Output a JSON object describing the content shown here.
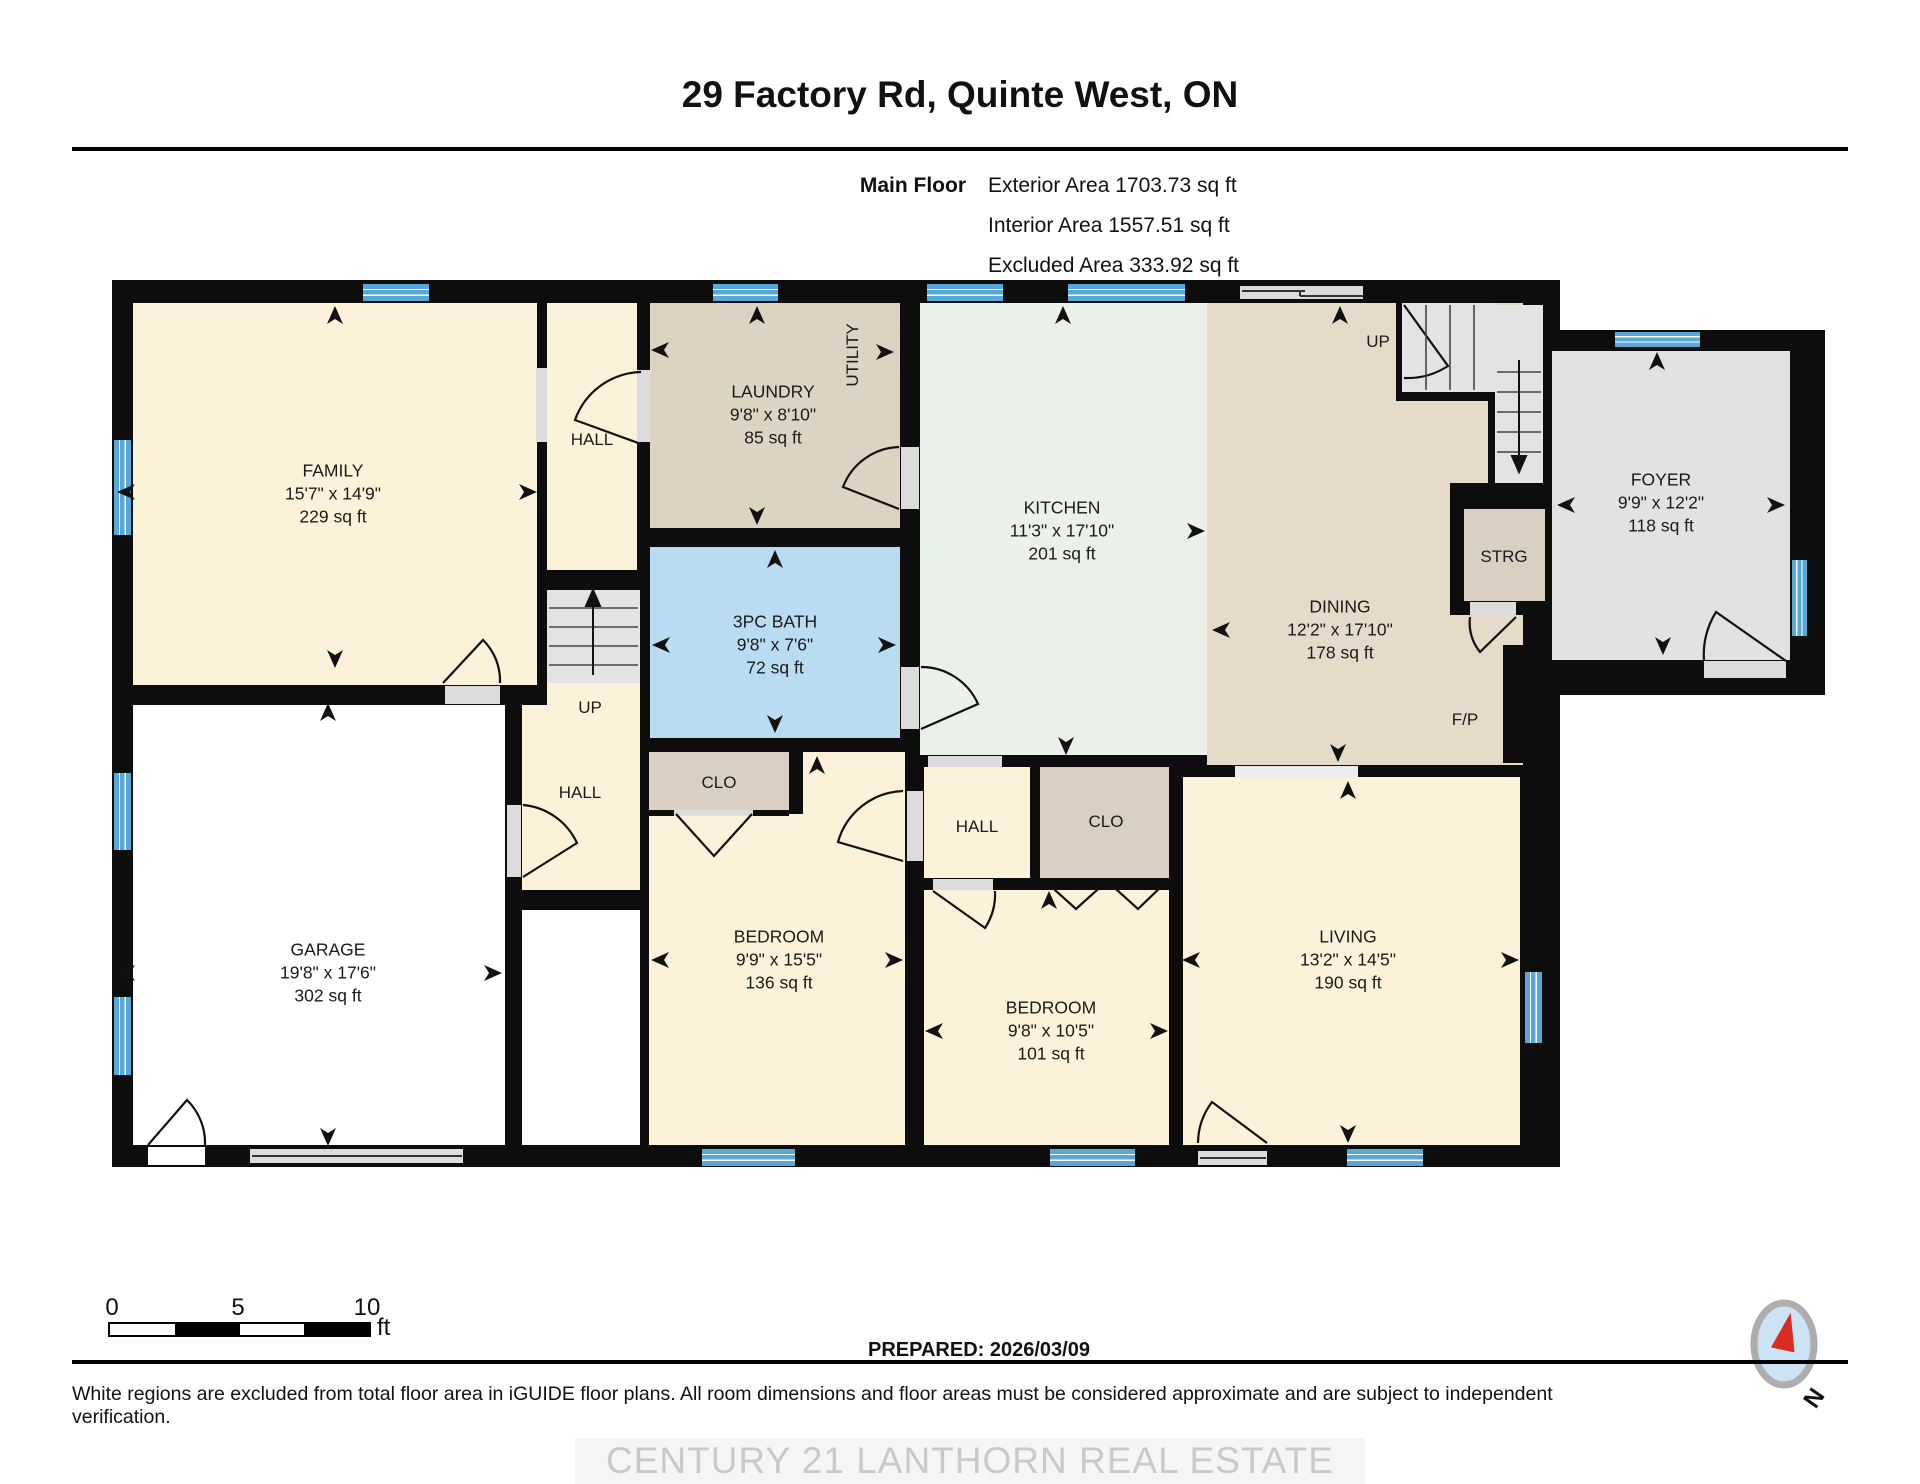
{
  "header": {
    "title": "29 Factory Rd, Quinte West, ON",
    "floor_label": "Main Floor",
    "stats": [
      "Exterior Area 1703.73 sq ft",
      "Interior Area 1557.51 sq ft",
      "Excluded Area 333.92 sq ft"
    ]
  },
  "rooms": [
    {
      "name": "FAMILY",
      "dims": "15'7\" x 14'9\"",
      "area": "229 sq ft"
    },
    {
      "name": "LAUNDRY",
      "dims": "9'8\" x 8'10\"",
      "area": "85 sq ft"
    },
    {
      "name": "KITCHEN",
      "dims": "11'3\" x 17'10\"",
      "area": "201 sq ft"
    },
    {
      "name": "DINING",
      "dims": "12'2\" x 17'10\"",
      "area": "178 sq ft"
    },
    {
      "name": "FOYER",
      "dims": "9'9\" x 12'2\"",
      "area": "118 sq ft"
    },
    {
      "name": "3PC BATH",
      "dims": "9'8\" x 7'6\"",
      "area": "72 sq ft"
    },
    {
      "name": "BEDROOM",
      "dims": "9'9\" x 15'5\"",
      "area": "136 sq ft"
    },
    {
      "name": "BEDROOM",
      "dims": "9'8\" x 10'5\"",
      "area": "101 sq ft"
    },
    {
      "name": "LIVING",
      "dims": "13'2\" x 14'5\"",
      "area": "190 sq ft"
    },
    {
      "name": "GARAGE",
      "dims": "19'8\" x 17'6\"",
      "area": "302 sq ft"
    }
  ],
  "labels": {
    "hall_top": "HALL",
    "hall_mid": "HALL",
    "hall_lower": "HALL",
    "up_stairs": "UP",
    "up_hall": "UP",
    "clo_left": "CLO",
    "clo_right": "CLO",
    "strg": "STRG",
    "utility": "UTILITY",
    "fireplace": "F/P"
  },
  "footer": {
    "scale_0": "0",
    "scale_5": "5",
    "scale_10": "10",
    "scale_unit": "ft",
    "prepared": "PREPARED: 2026/03/09",
    "disclaimer": "White regions are excluded from total floor area in iGUIDE floor plans. All room dimensions and floor areas must be considered approximate and are subject to independent verification.",
    "watermark": "CENTURY 21 LANTHORN REAL ESTATE LTD., Brokerage",
    "compass_n": "N"
  },
  "colors": {
    "wall": "#0d0d0d",
    "cream": "#FBF2D9",
    "laundry-tan": "#DDD3C2",
    "dining-tan": "#E5DBC8",
    "closet-tan": "#D9CFC2",
    "kitchen-mint": "#E9F1E9",
    "bath-blue": "#B9DCF3",
    "excluded-gray": "#E2E2E2",
    "stair-gray": "#E3E3E3",
    "window-blue": "#57A7D8",
    "door-gray": "#DCDCDC",
    "compass-red": "#D92B21"
  }
}
